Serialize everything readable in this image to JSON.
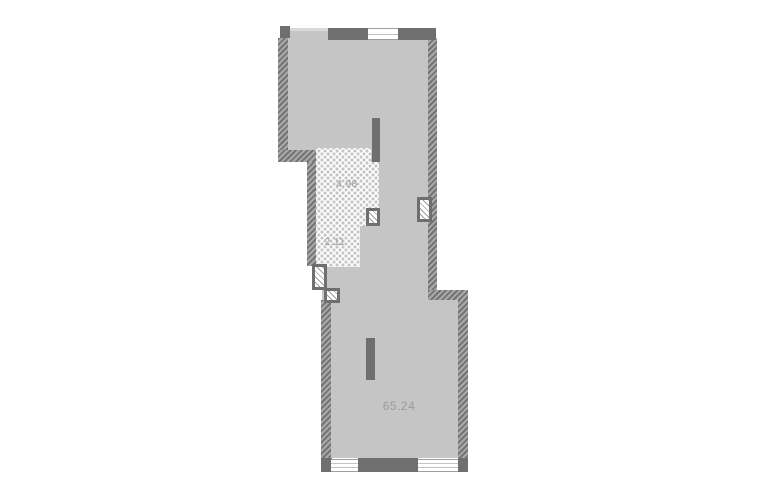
{
  "plan": {
    "type": "apartment-floor-plan",
    "rooms": [
      {
        "name": "wet-zone-upper",
        "area": "4.98"
      },
      {
        "name": "wet-zone-lower",
        "area": "2.11"
      },
      {
        "name": "main-space",
        "area": "65.24"
      }
    ],
    "icons": {
      "vent_shaft": "hatched-square-vent-symbol",
      "window": "double-line-window-symbol"
    },
    "colors": {
      "background": "#ffffff",
      "floor": "#c5c5c5",
      "wall": "#6f6f6f",
      "hatch_light": "#a9a9a9",
      "hatch_dark": "#747474",
      "tile_dot": "#c4c4c4",
      "label_text": "#9b9b9b"
    }
  }
}
